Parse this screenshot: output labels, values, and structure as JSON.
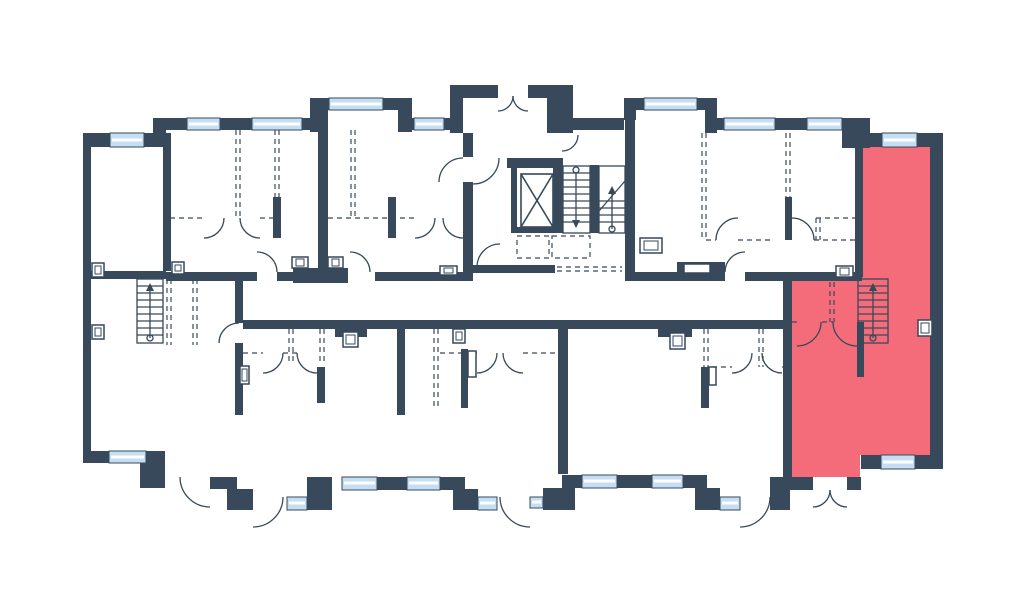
{
  "page": {
    "kind": "building-floor-plan",
    "background": "#FFFFFF"
  },
  "colors": {
    "wall": "#37495A",
    "line": "#37495A",
    "window": "#C6DEF4",
    "window_stripe": "#FFFFFF",
    "floor": "#FFFFFF",
    "highlight": "#F46B79"
  },
  "floorplan": {
    "highlighted_unit": {
      "id": "unit-highlighted",
      "fill": "#F46B79",
      "position": "right-side",
      "has_internal_staircase": true
    },
    "core": {
      "has_elevator": true,
      "has_double_stair_flights": true,
      "has_entrance_vestibule": true
    },
    "icons": [
      "elevator-icon",
      "stairs-core-icon",
      "stairs-left-unit-icon",
      "stairs-highlighted-unit-icon",
      "door-arc-icon",
      "window-icon",
      "vent-box-icon"
    ]
  }
}
